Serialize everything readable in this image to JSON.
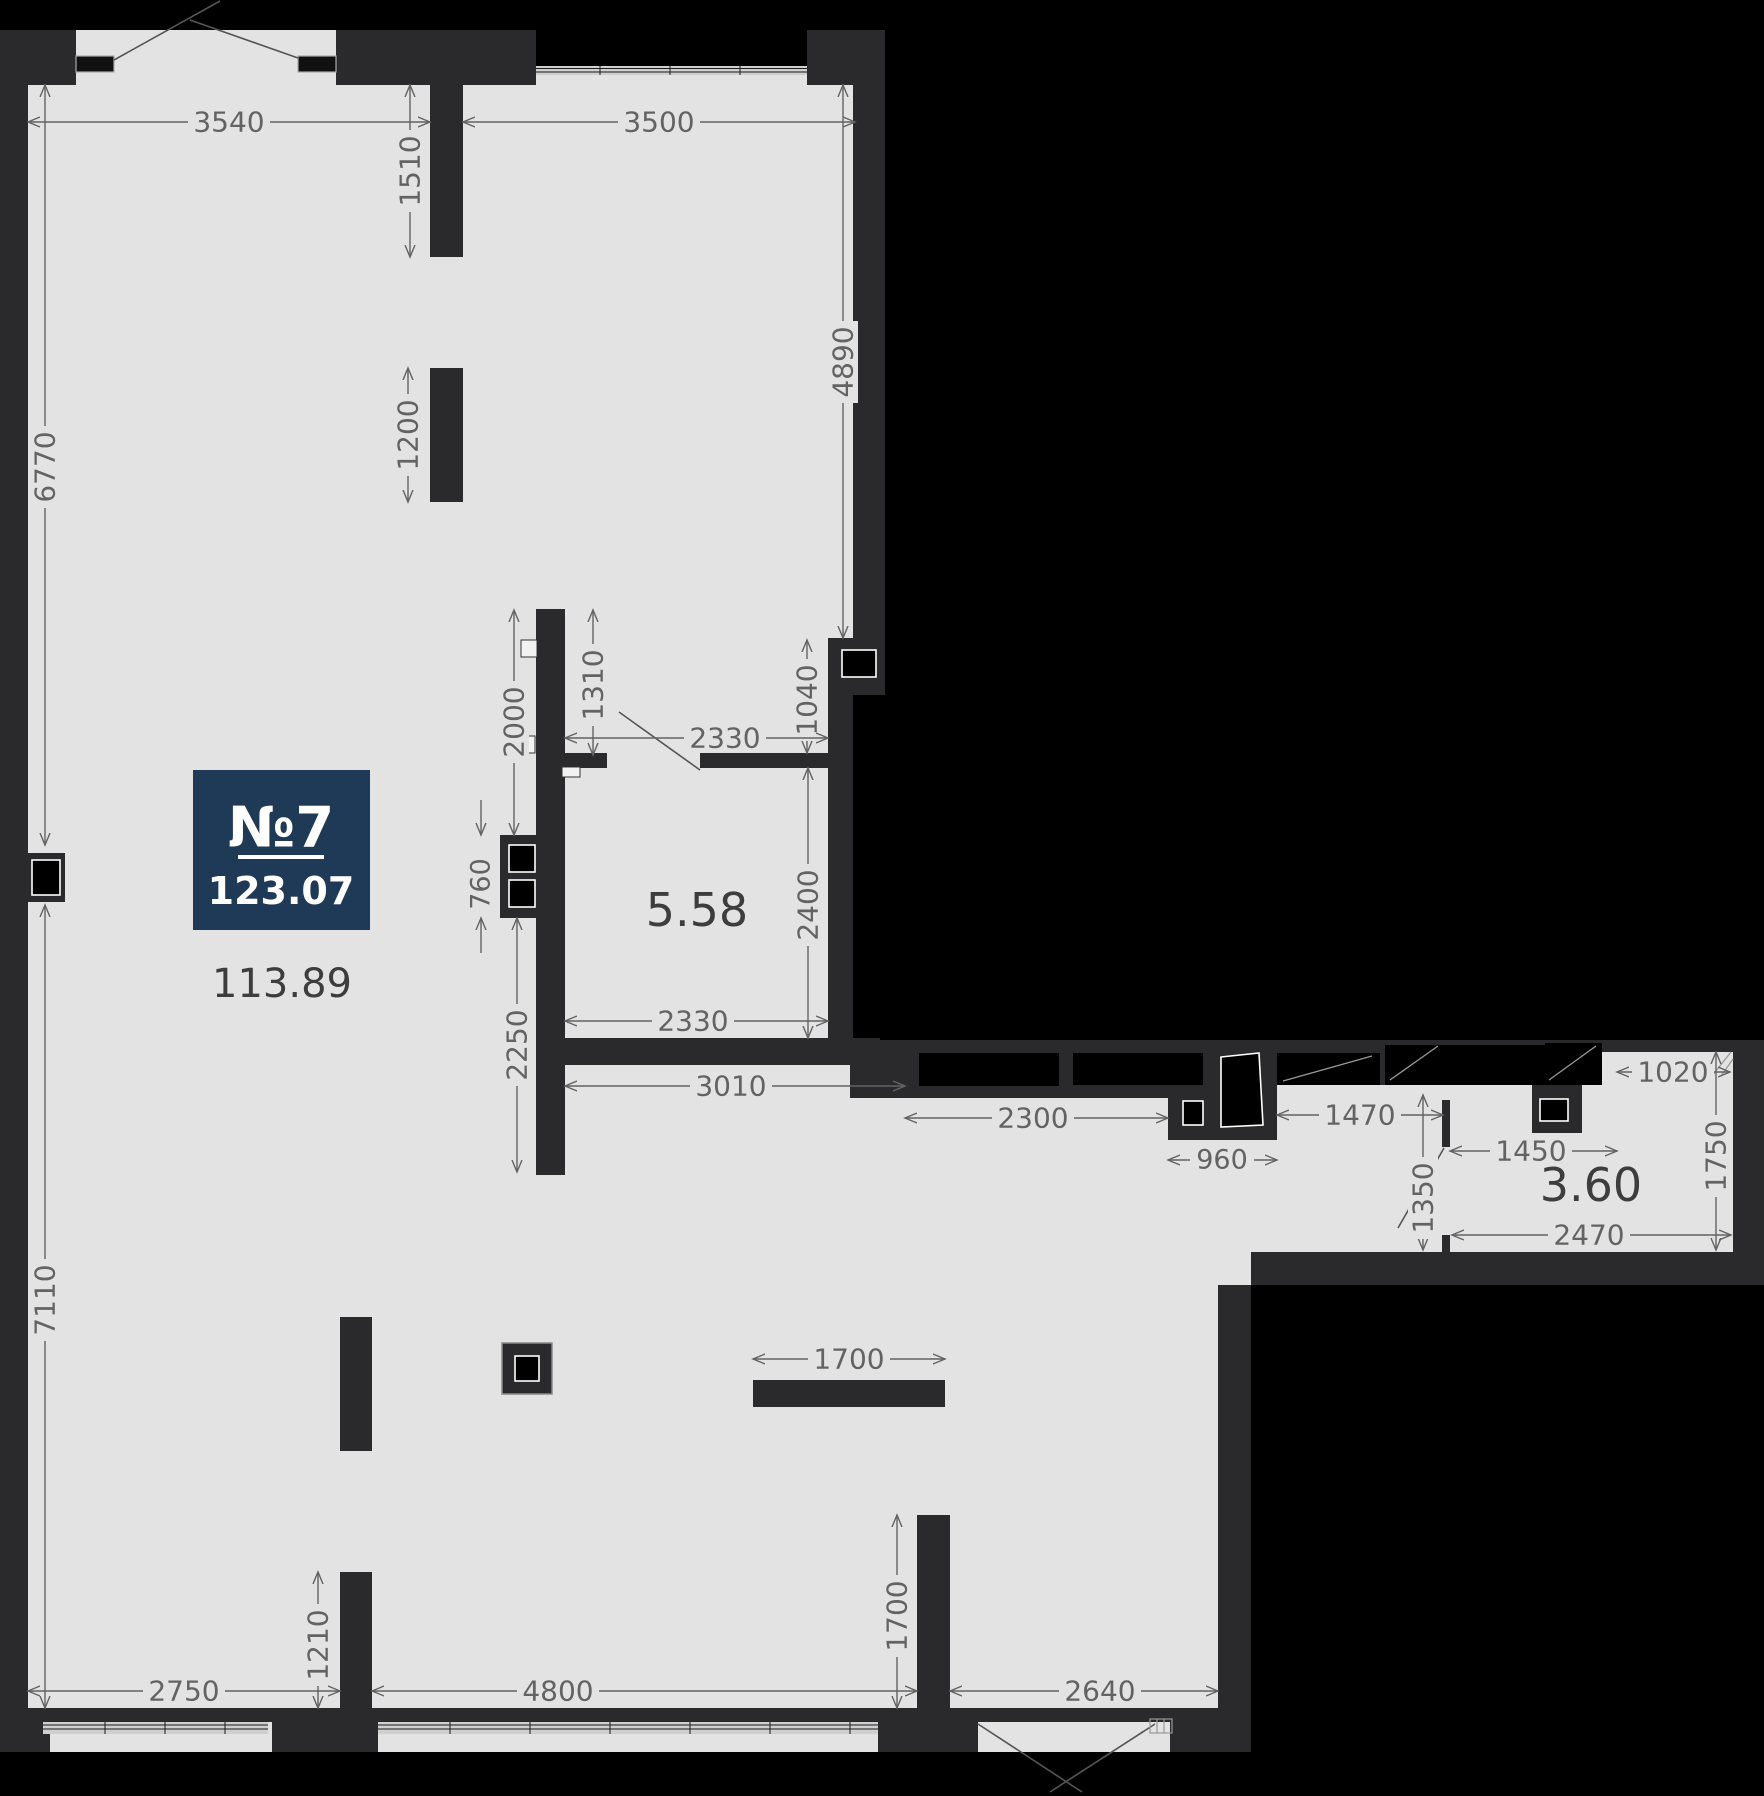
{
  "unit": {
    "number": "№7",
    "total_area": "123.07"
  },
  "rooms": [
    {
      "id": "main-open-space",
      "area_label": "113.89"
    },
    {
      "id": "bathroom",
      "area_label": "5.58"
    },
    {
      "id": "hall",
      "area_label": "3.60"
    }
  ],
  "dims": [
    {
      "value": "3540",
      "edge": "top"
    },
    {
      "value": "3500",
      "edge": "top"
    },
    {
      "value": "1510",
      "edge": "interior"
    },
    {
      "value": "1200",
      "edge": "interior"
    },
    {
      "value": "6770",
      "edge": "left"
    },
    {
      "value": "4890",
      "edge": "interior"
    },
    {
      "value": "2000",
      "edge": "interior"
    },
    {
      "value": "1310",
      "edge": "interior"
    },
    {
      "value": "1040",
      "edge": "interior"
    },
    {
      "value": "2330",
      "edge": "interior"
    },
    {
      "value": "2400",
      "edge": "interior"
    },
    {
      "value": "760",
      "edge": "interior"
    },
    {
      "value": "2330",
      "edge": "interior"
    },
    {
      "value": "2250",
      "edge": "interior"
    },
    {
      "value": "3010",
      "edge": "interior"
    },
    {
      "value": "2300",
      "edge": "interior"
    },
    {
      "value": "960",
      "edge": "interior"
    },
    {
      "value": "1470",
      "edge": "interior"
    },
    {
      "value": "1350",
      "edge": "interior"
    },
    {
      "value": "1450",
      "edge": "interior"
    },
    {
      "value": "1020",
      "edge": "interior"
    },
    {
      "value": "1750",
      "edge": "right"
    },
    {
      "value": "2470",
      "edge": "interior"
    },
    {
      "value": "7110",
      "edge": "left"
    },
    {
      "value": "1700",
      "edge": "interior"
    },
    {
      "value": "1700",
      "edge": "interior"
    },
    {
      "value": "1210",
      "edge": "interior"
    },
    {
      "value": "2750",
      "edge": "bottom"
    },
    {
      "value": "4800",
      "edge": "bottom"
    },
    {
      "value": "2640",
      "edge": "bottom"
    }
  ],
  "colors": {
    "background": "#000000",
    "walls": "#2a2a2c",
    "floor": "#e3e3e3",
    "dimension_text": "#636363",
    "room_label": "#3d3d3d",
    "badge": "#1f3a57",
    "badge_text": "#ffffff"
  }
}
